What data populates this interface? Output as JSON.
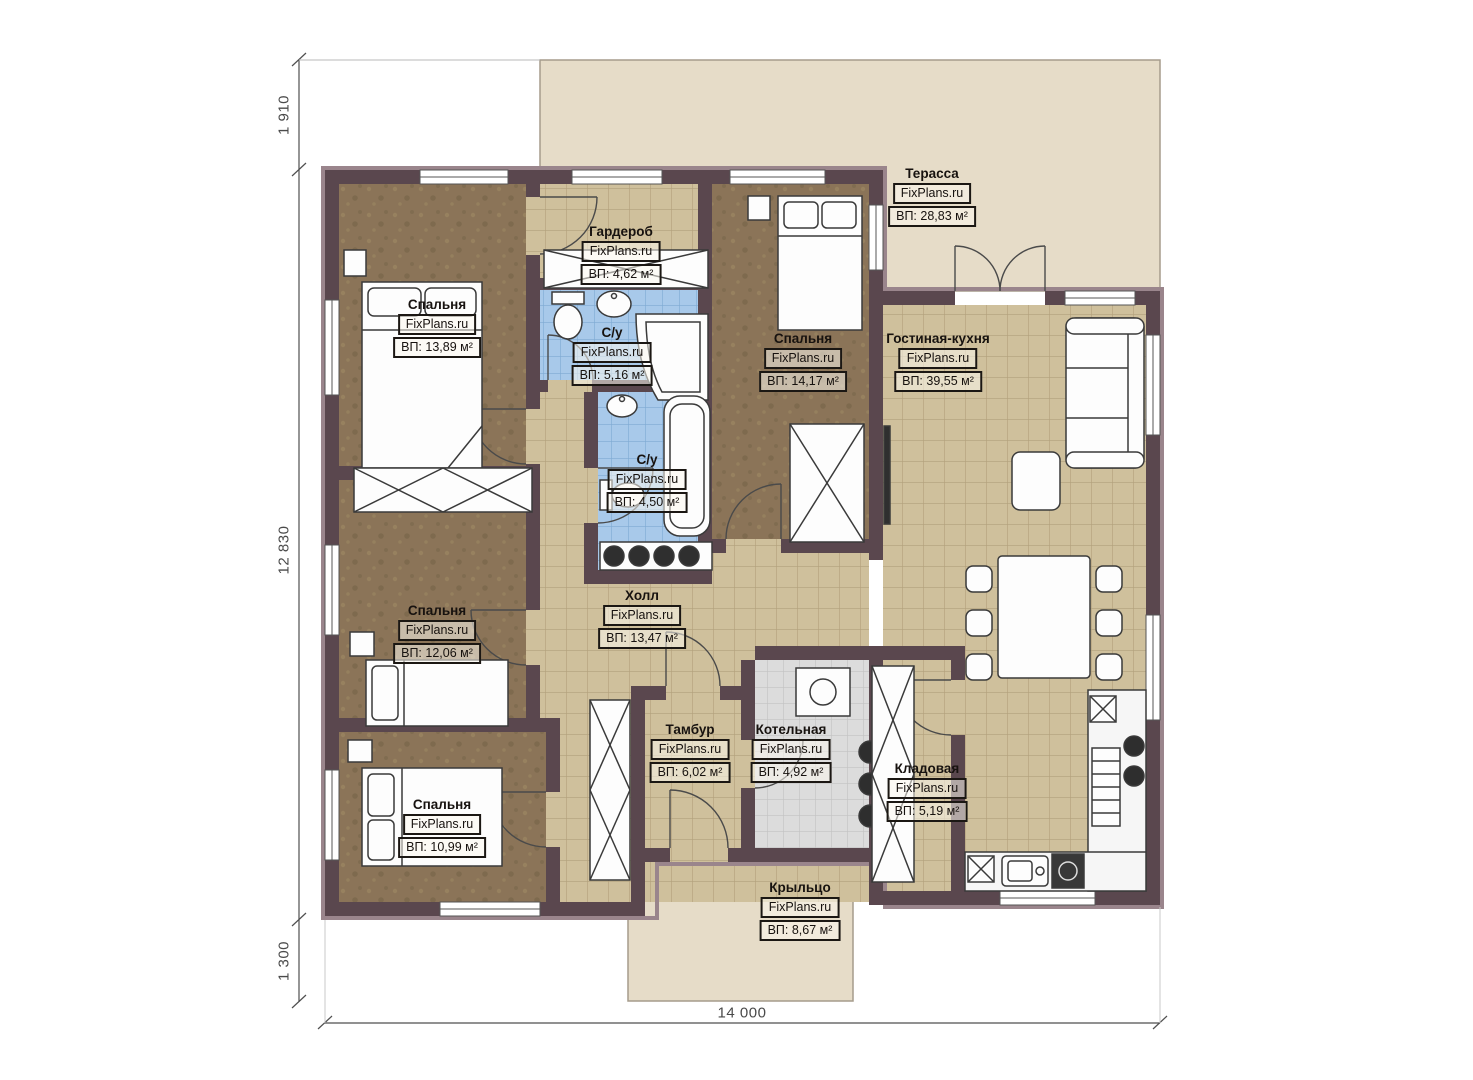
{
  "brand": "FixPlans.ru",
  "plan": {
    "rooms": [
      {
        "id": "terrace",
        "name": "Терасса",
        "area": "ВП: 28,83 м²"
      },
      {
        "id": "wardrobe",
        "name": "Гардероб",
        "area": "ВП: 4,62 м²"
      },
      {
        "id": "bathroom-1",
        "name": "С/у",
        "area": "ВП: 5,16 м²"
      },
      {
        "id": "bedroom-1",
        "name": "Спальня",
        "area": "ВП: 13,89 м²"
      },
      {
        "id": "bedroom-2",
        "name": "Спальня",
        "area": "ВП: 14,17 м²"
      },
      {
        "id": "living-kitchen",
        "name": "Гостиная-кухня",
        "area": "ВП: 39,55 м²"
      },
      {
        "id": "bathroom-2",
        "name": "С/у",
        "area": "ВП: 4,50 м²"
      },
      {
        "id": "hall",
        "name": "Холл",
        "area": "ВП: 13,47 м²"
      },
      {
        "id": "bedroom-3",
        "name": "Спальня",
        "area": "ВП: 12,06 м²"
      },
      {
        "id": "bedroom-4",
        "name": "Спальня",
        "area": "ВП: 10,99 м²"
      },
      {
        "id": "vestibule",
        "name": "Тамбур",
        "area": "ВП: 6,02 м²"
      },
      {
        "id": "boiler-room",
        "name": "Котельная",
        "area": "ВП: 4,92 м²"
      },
      {
        "id": "storage",
        "name": "Кладовая",
        "area": "ВП: 5,19 м²"
      },
      {
        "id": "porch",
        "name": "Крыльцо",
        "area": "ВП: 8,67 м²"
      }
    ],
    "dimensions": {
      "offset_top": "1 910",
      "house_depth": "12 830",
      "offset_bottom": "1 300",
      "house_width": "14 000"
    },
    "colors": {
      "wall": "#5a474e",
      "wall_outer_band": "#9a858c",
      "bedroom_floor": "#8b7458",
      "tile_floor": "#cfc09c",
      "bath_floor": "#a8c9ea",
      "boiler_floor": "#dcdcdc",
      "terrace": "#e6dcc8",
      "dimension_line": "#4f4f4f"
    }
  }
}
